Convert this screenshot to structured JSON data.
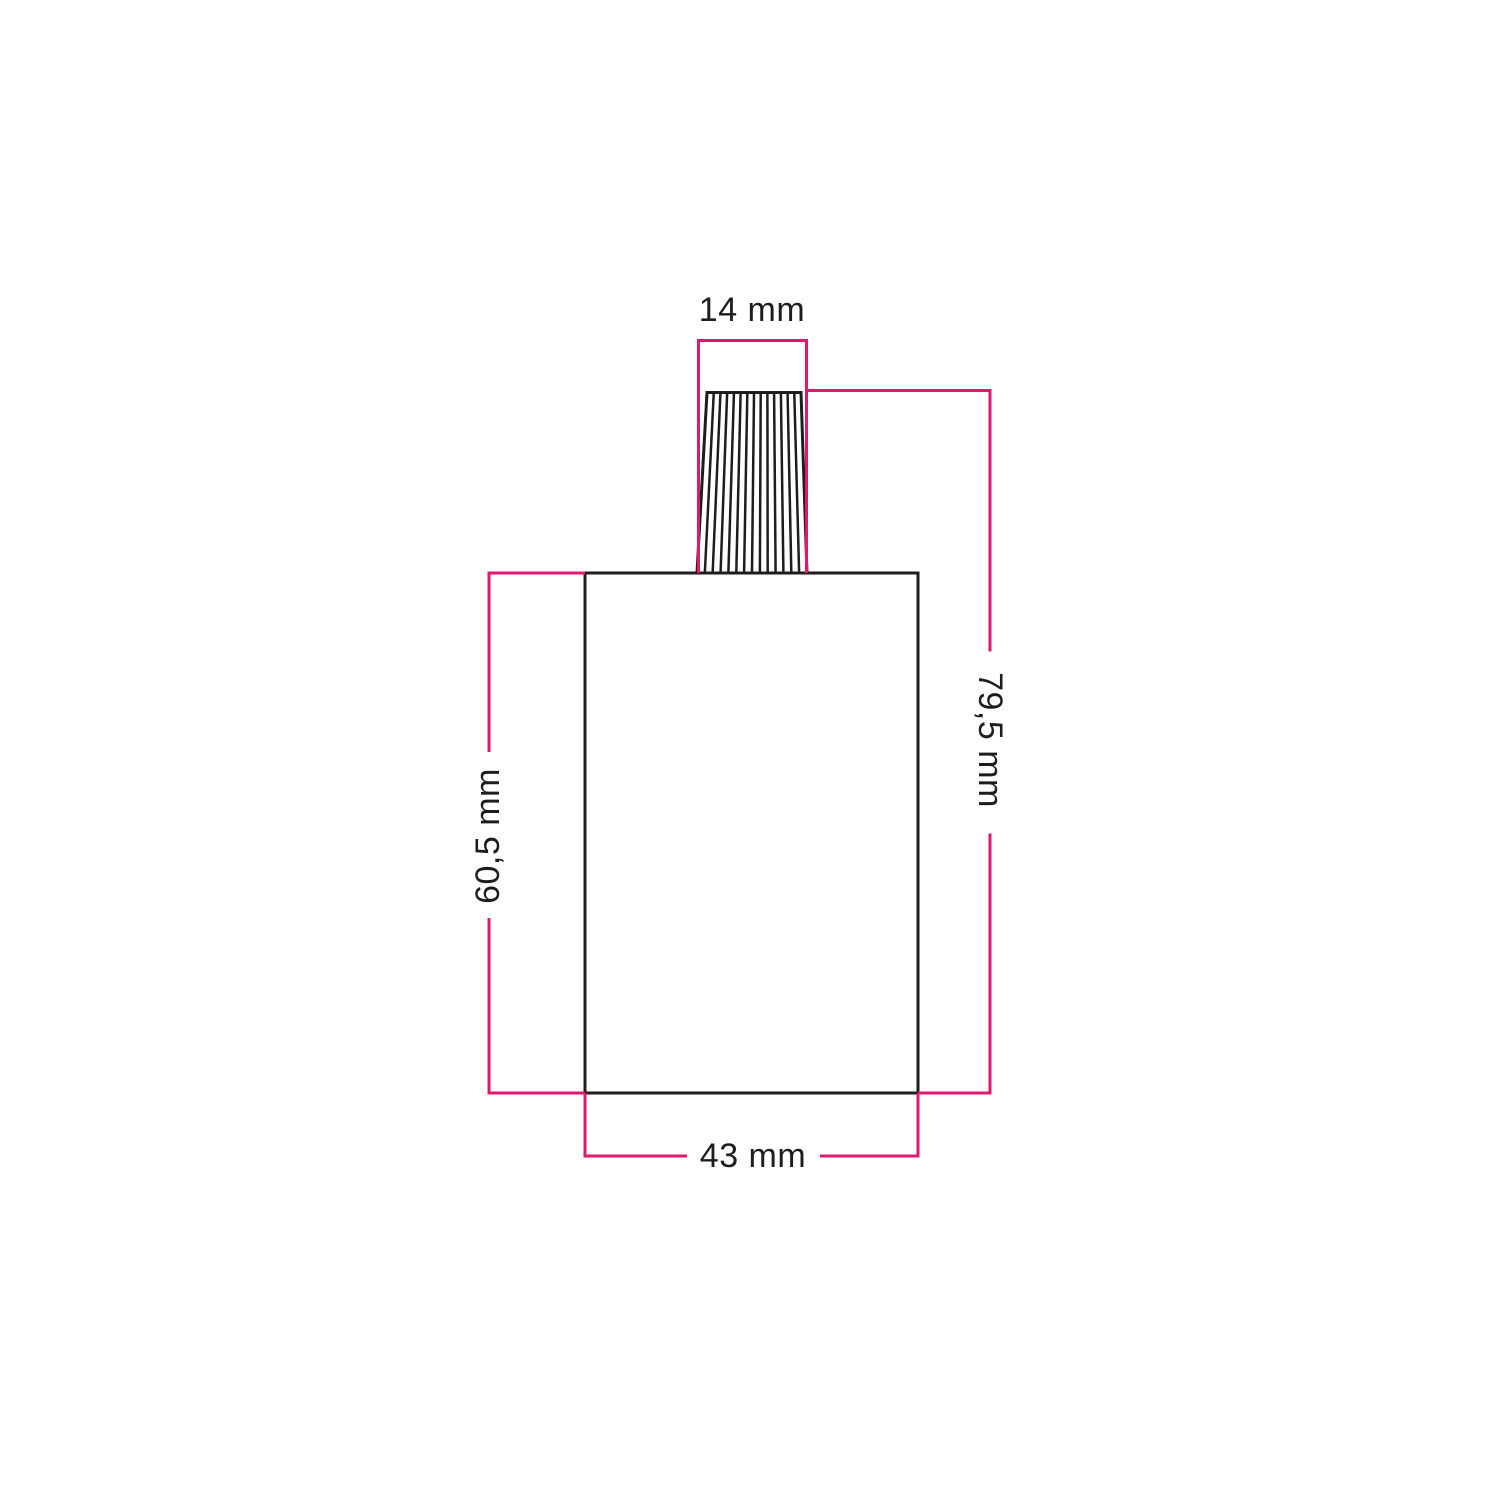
{
  "page": {
    "background_color": "#ffffff"
  },
  "diagram": {
    "type": "technical-dimension-drawing",
    "labels": {
      "gland_width": "14 mm",
      "total_height": "79,5 mm",
      "body_height": "60,5 mm",
      "body_width": "43 mm"
    },
    "values": {
      "gland_width_mm": 14,
      "total_height_mm": 79.5,
      "body_height_mm": 60.5,
      "body_width_mm": 43
    },
    "colors": {
      "dimension_line": "#e2186f",
      "outline": "#1d1d1b",
      "label_text": "#1d1d1b"
    }
  }
}
